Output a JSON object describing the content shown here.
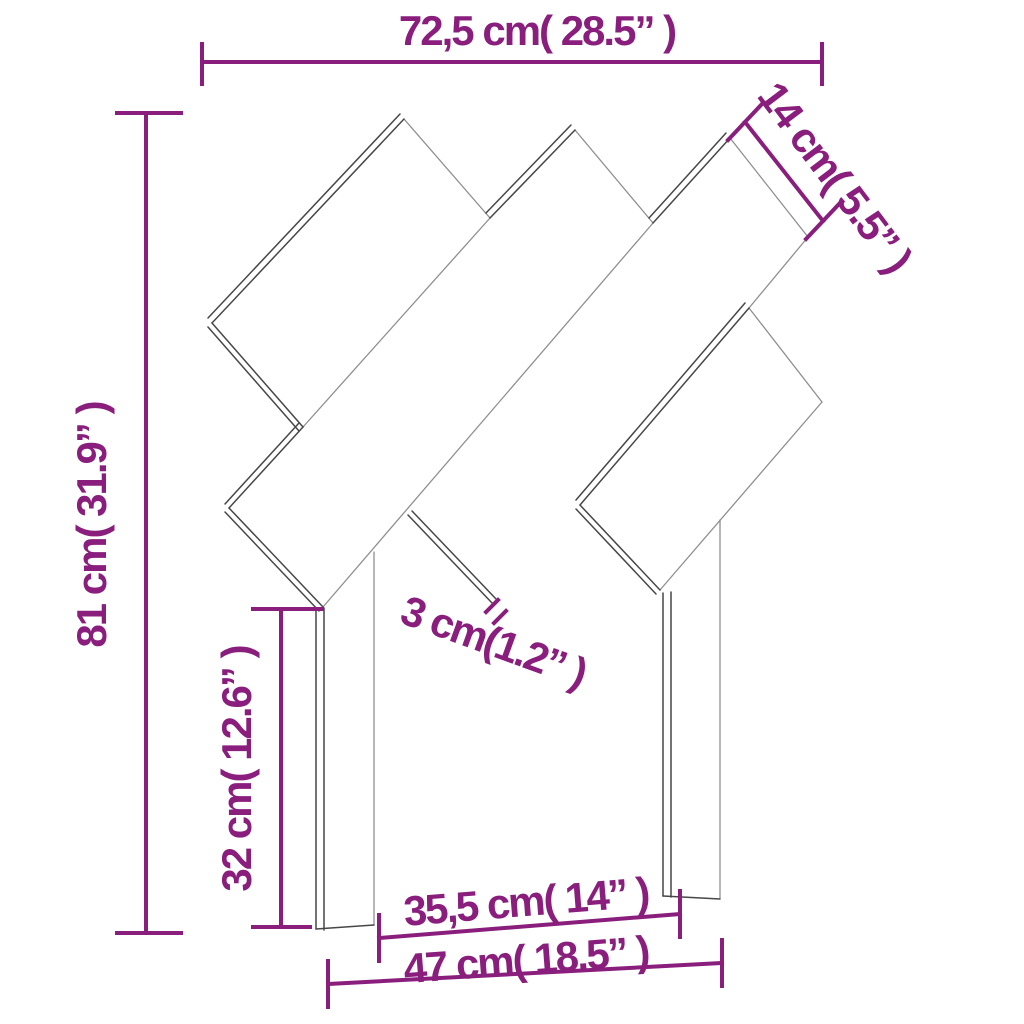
{
  "diagram": {
    "title": "headboard-dimension-diagram"
  },
  "dimensions": {
    "top_width": {
      "label": "72,5 cm( 28.5” )"
    },
    "board_width": {
      "label": "14 cm( 5.5” )"
    },
    "total_height": {
      "label": "81 cm( 31.9” )"
    },
    "leg_height": {
      "label": "32 cm( 12.6” )"
    },
    "board_thickness": {
      "label": "3 cm(1.2” )"
    },
    "inner_leg_span": {
      "label": "35,5 cm( 14” )"
    },
    "outer_leg_span": {
      "label": "47 cm( 18.5” )"
    }
  },
  "colors": {
    "dimension": "#8A1E7D",
    "line_dark": "#474747",
    "line_light": "#8f8f8f",
    "background": "#ffffff"
  }
}
